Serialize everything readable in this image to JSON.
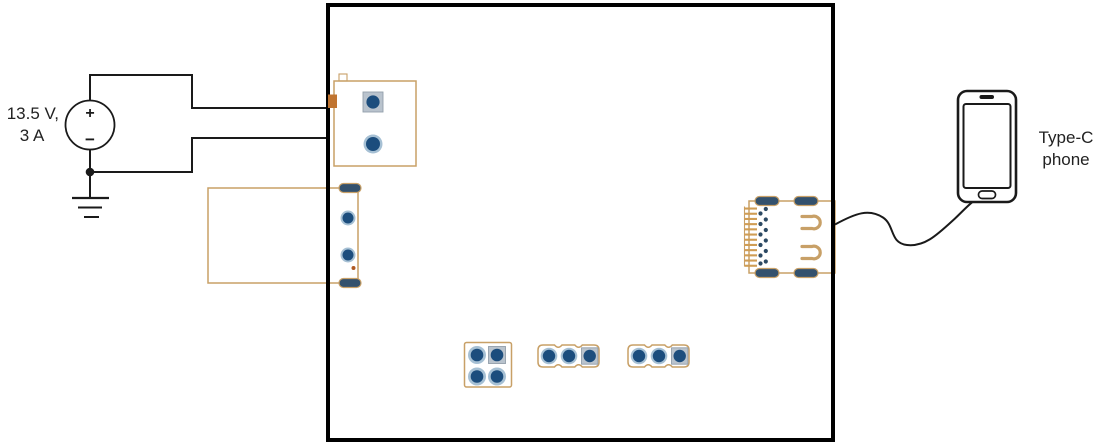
{
  "power_source": {
    "label_line1": "13.5 V,",
    "label_line2": "3 A",
    "plus": "+",
    "minus": "−"
  },
  "phone": {
    "label_line1": "Type-C",
    "label_line2": "phone"
  },
  "colors": {
    "wire": "#1a1a1a",
    "board": "#000000",
    "text": "#222222",
    "tan": "#c8a067",
    "tanfill": "#cf9d55",
    "navy": "#1c4d7d",
    "halo": "#a6c0d4",
    "sqpad": "#b9c3cd",
    "pill": "#33516d",
    "orange": "#c07430",
    "dot": "#b05a24"
  }
}
